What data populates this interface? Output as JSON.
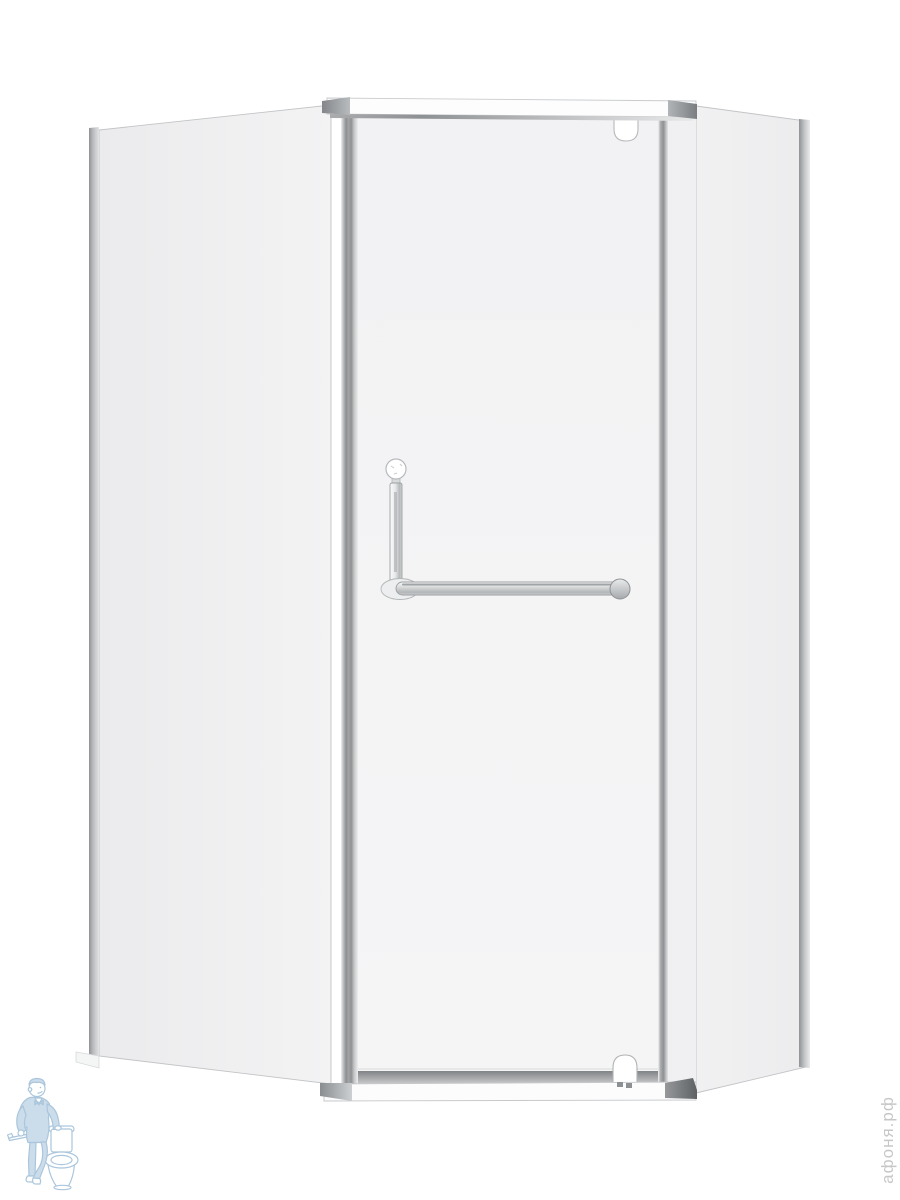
{
  "scene": {
    "description": "Corner pentagonal shower enclosure with clear glass panels, chrome profiles, pivot door and L-shaped towel-bar handle on a white background",
    "background_color": "#ffffff"
  },
  "watermarks": {
    "store_text": "афоня.рф",
    "store_text_color": "#c7c7c7",
    "logo_name": "plumber-with-toilet-logo",
    "logo_color": "#9dbdd6"
  },
  "palette": {
    "glass": "#f2f2f4",
    "chrome_light": "#e8e9ea",
    "chrome_mid": "#9fa2a5",
    "cap_dark": "#63676a",
    "hardware_white": "#ffffff"
  }
}
